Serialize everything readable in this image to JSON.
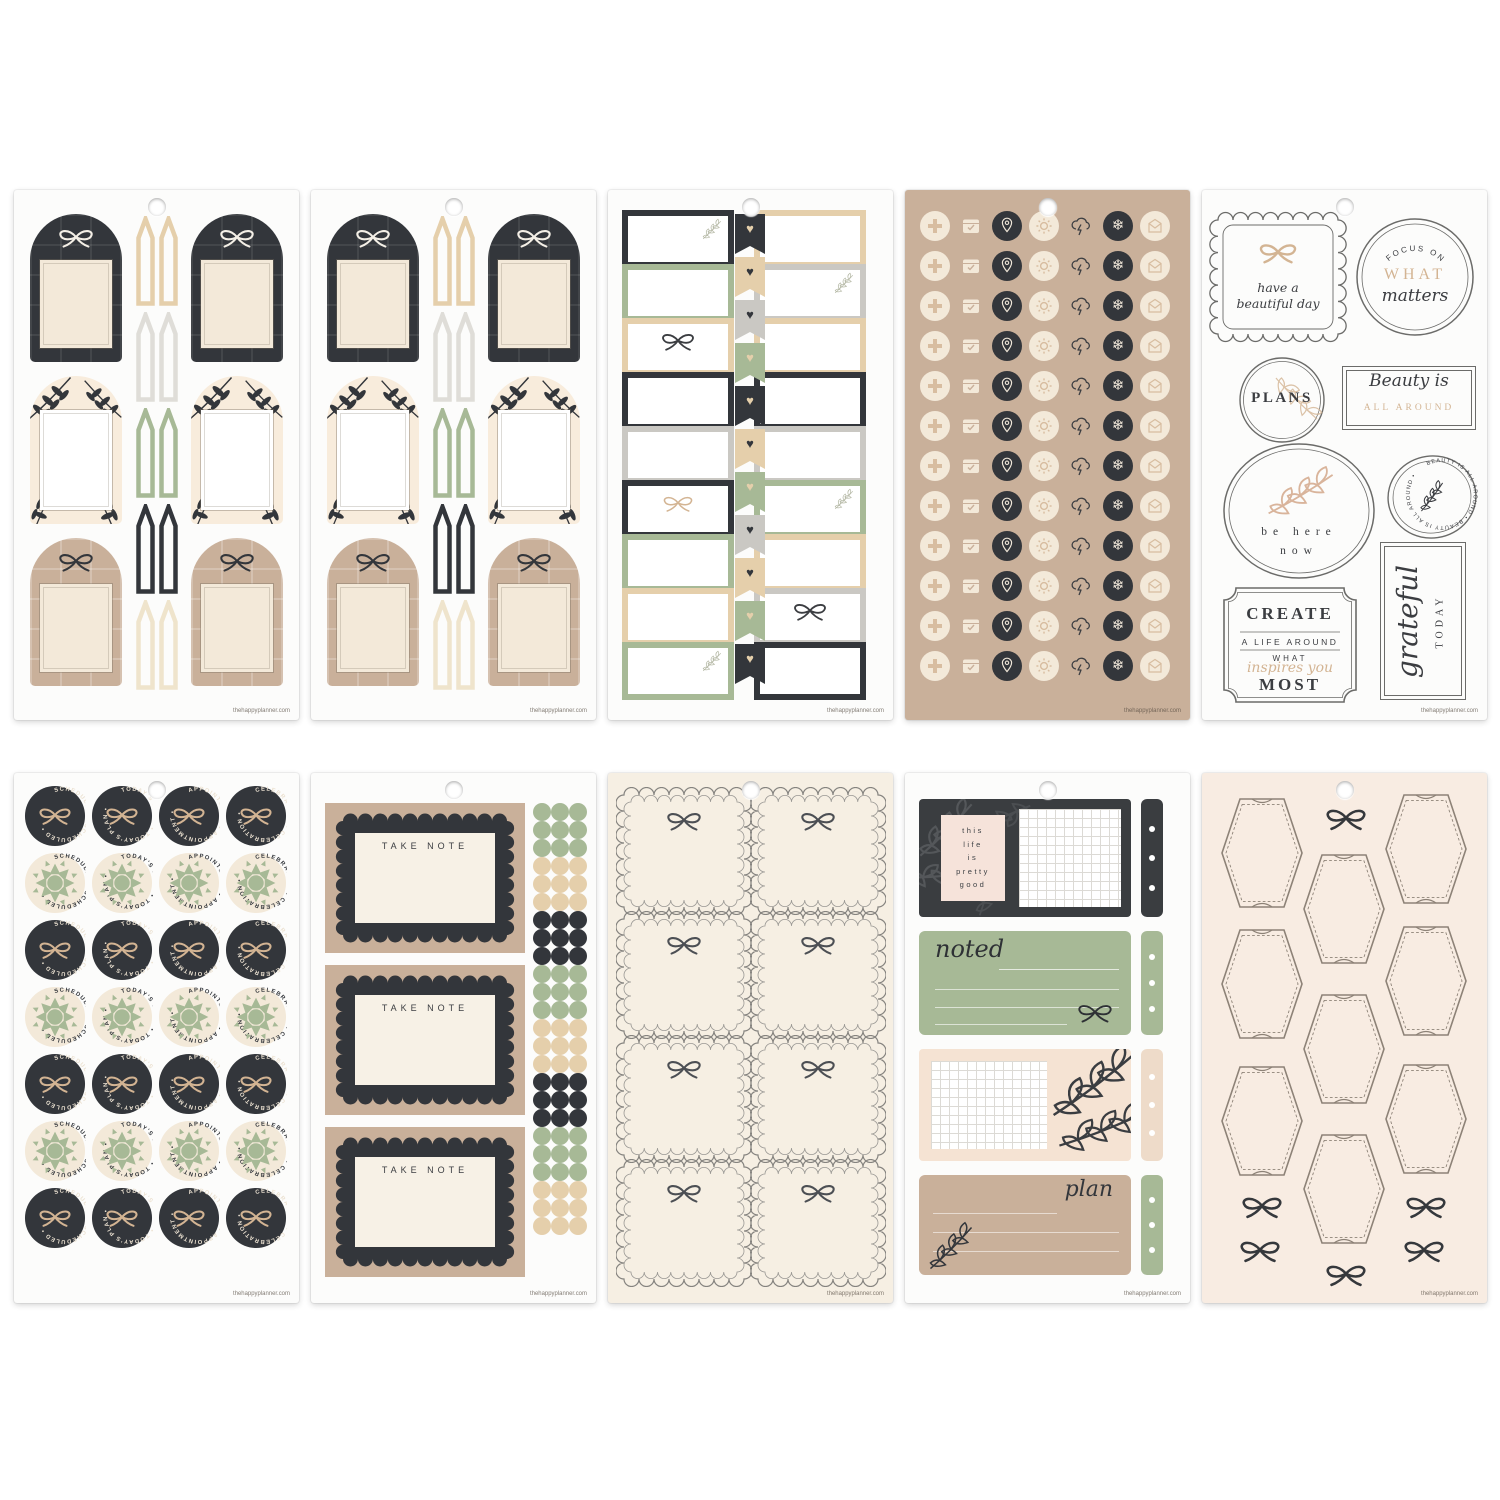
{
  "page": {
    "background": "#ffffff",
    "site_url": "thehappyplanner.com"
  },
  "colors": {
    "sheet_white": "#fcfcfb",
    "sheet_cream": "#f6efe3",
    "sheet_blush": "#f8ece2",
    "kraft": "#c9b09a",
    "black": "#33363b",
    "green": "#a7b996",
    "tan": "#e5cfab",
    "tan_deep": "#d3b493",
    "cream": "#f3e9d9",
    "cream2": "#f7f1e6",
    "gray": "#cac8c3",
    "gray_light": "#dfddd8",
    "cream_flag": "#efe4cc",
    "white": "#ffffff",
    "ink": "#3b3d41",
    "line": "#6b6b69",
    "blush_card": "#f6e3da",
    "dark_panel": "#3a3d40"
  },
  "icons": {
    "heart": "♥",
    "snowflake": "❄"
  },
  "sheets": [
    {
      "id": "arch-tags-1",
      "type": "arch_tags",
      "bg": "white",
      "rows": [
        {
          "arch_style": "plaid_black",
          "bow_color": "white",
          "label_bg": "cream"
        },
        {
          "arch_style": "leaves",
          "bow_color": null,
          "label_bg": "white"
        },
        {
          "arch_style": "plaid_kraft",
          "bow_color": "black",
          "label_bg": "cream"
        }
      ],
      "flag_pairs": [
        "tan",
        "gray_light",
        "green",
        "black",
        "cream_flag"
      ]
    },
    {
      "id": "arch-tags-2",
      "type": "arch_tags",
      "bg": "white",
      "rows": [
        {
          "arch_style": "plaid_black",
          "bow_color": "white",
          "label_bg": "cream"
        },
        {
          "arch_style": "leaves",
          "bow_color": null,
          "label_bg": "white"
        },
        {
          "arch_style": "plaid_kraft",
          "bow_color": "black",
          "label_bg": "cream"
        }
      ],
      "flag_pairs": [
        "tan",
        "gray_light",
        "green",
        "black",
        "cream_flag"
      ]
    },
    {
      "id": "label-boxes",
      "type": "label_boxes",
      "bg": "white",
      "left_column": [
        {
          "border": "black",
          "motif": "leaf"
        },
        {
          "border": "green"
        },
        {
          "border": "tan",
          "motif": "bow_black"
        },
        {
          "border": "black"
        },
        {
          "border": "gray"
        },
        {
          "border": "black",
          "motif": "bow_tan"
        },
        {
          "border": "green"
        },
        {
          "border": "tan"
        },
        {
          "border": "green",
          "motif": "leaf"
        }
      ],
      "right_column": [
        {
          "border": "tan"
        },
        {
          "border": "gray",
          "motif": "leaf"
        },
        {
          "border": "tan"
        },
        {
          "border": "black"
        },
        {
          "border": "gray"
        },
        {
          "border": "green",
          "motif": "leaf"
        },
        {
          "border": "tan"
        },
        {
          "border": "gray",
          "motif": "bow_black"
        },
        {
          "border": "black"
        }
      ],
      "heart_flags": [
        "black",
        "tan",
        "gray",
        "green",
        "black",
        "tan",
        "green",
        "gray",
        "tan",
        "green",
        "black"
      ]
    },
    {
      "id": "icon-dots",
      "type": "icon_circles",
      "bg": "kraft",
      "row_count": 12,
      "icons": [
        "medical-cross",
        "calendar",
        "location-pin",
        "sun",
        "storm-cloud",
        "snowflake",
        "envelope"
      ]
    },
    {
      "id": "quotes",
      "type": "quote_labels",
      "bg": "white",
      "stickers": [
        {
          "shape": "scallop_square",
          "lines": [
            "have a",
            "beautiful day"
          ]
        },
        {
          "shape": "round_badge",
          "arc_text": "FOCUS ON",
          "big_text": "WHAT",
          "script_text": "matters"
        },
        {
          "shape": "circle",
          "big_text": "PLANS"
        },
        {
          "shape": "rect",
          "script_text": "Beauty is",
          "sub_text": "ALL AROUND"
        },
        {
          "shape": "oval",
          "lines": [
            "be here",
            "now"
          ]
        },
        {
          "shape": "oval_badge",
          "circular_text": "BEAUTY IS ALL AROUND • BEAUTY IS ALL AROUND • "
        },
        {
          "shape": "ticket",
          "lines": [
            "CREATE",
            "A LIFE AROUND",
            "WHAT",
            "inspires you",
            "MOST"
          ]
        },
        {
          "shape": "tall_rect",
          "script_text": "grateful",
          "sub_text": "TODAY"
        }
      ]
    },
    {
      "id": "round-seals",
      "type": "round_seals",
      "bg": "white",
      "labels": [
        "SCHEDULED",
        "TODAY'S PLAN",
        "APPOINTMENT",
        "CELEBRATION"
      ],
      "row_styles": [
        "dark_bow",
        "quilt",
        "dark_bow",
        "quilt",
        "dark_bow",
        "quilt",
        "dark_bow"
      ]
    },
    {
      "id": "take-note",
      "type": "take_note",
      "bg": "white",
      "card_title": "TAKE NOTE",
      "card_count": 3,
      "dot_clusters": [
        "green",
        "tan",
        "black",
        "green",
        "tan",
        "black",
        "green",
        "tan"
      ]
    },
    {
      "id": "scallop-frames",
      "type": "scallop_squares",
      "bg": "cream_sheet",
      "rows": 4,
      "cols": 2
    },
    {
      "id": "note-boxes",
      "type": "note_boxes",
      "bg": "white",
      "blocks": [
        {
          "style": "dark_leaf",
          "quote_lines": [
            "this",
            "life",
            "is",
            "pretty",
            "good"
          ],
          "tab": "dark"
        },
        {
          "style": "green_lines",
          "script_text": "noted",
          "tab": "green"
        },
        {
          "style": "blush_grid_leaf",
          "tab": "blush"
        },
        {
          "style": "kraft_lines",
          "script_text": "plan",
          "tab": "green"
        }
      ]
    },
    {
      "id": "hex-tags",
      "type": "hex_tags",
      "bg": "blush_sheet",
      "hex_count": 9,
      "bow_count": 6
    }
  ]
}
